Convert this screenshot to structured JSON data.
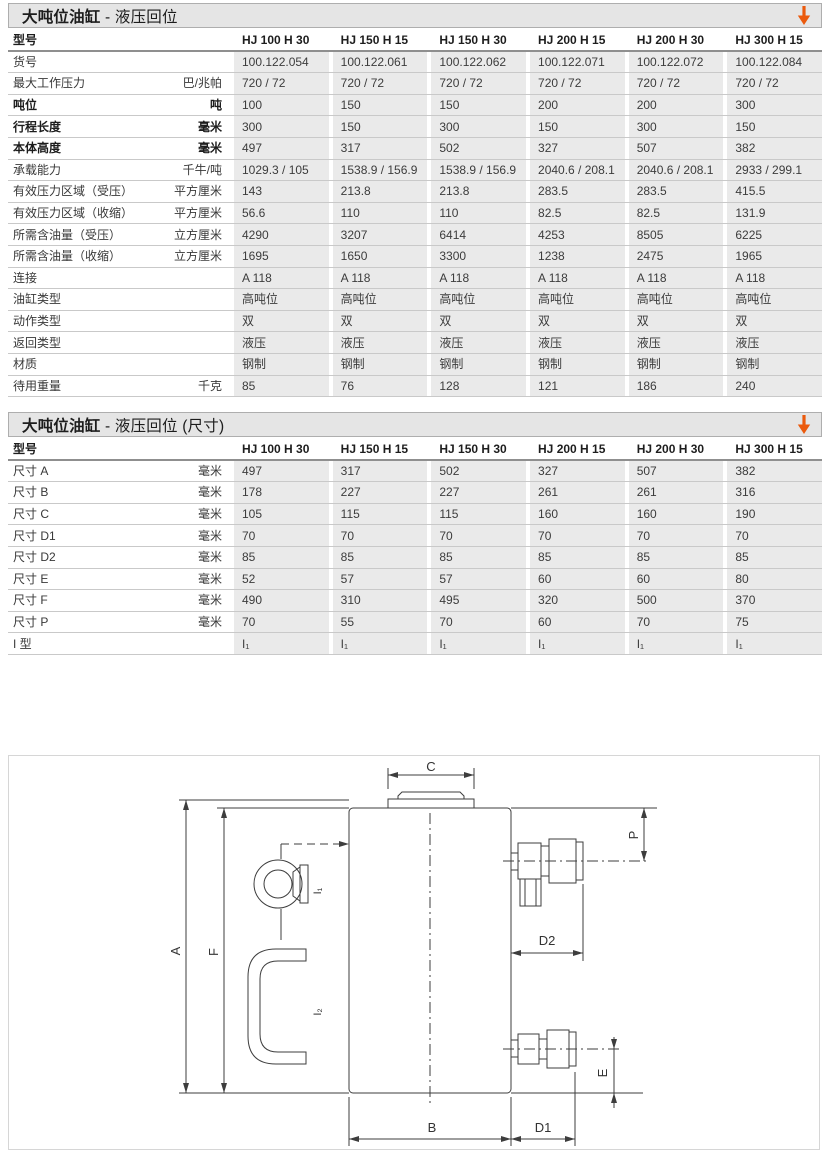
{
  "accent": {
    "arrow_color": "#EB5A0D"
  },
  "table1": {
    "title_bold": "大吨位油缸",
    "title_rest": " - 液压回位",
    "header_label": "型号",
    "models": [
      "HJ 100 H 30",
      "HJ 150 H 15",
      "HJ 150 H 30",
      "HJ 200 H 15",
      "HJ 200 H 30",
      "HJ 300 H 15"
    ],
    "rows": [
      {
        "label": "货号",
        "unit": "",
        "bold": false,
        "values": [
          "100.122.054",
          "100.122.061",
          "100.122.062",
          "100.122.071",
          "100.122.072",
          "100.122.084"
        ]
      },
      {
        "label": "最大工作压力",
        "unit": "巴/兆帕",
        "bold": false,
        "values": [
          "720 / 72",
          "720 / 72",
          "720 / 72",
          "720 / 72",
          "720 / 72",
          "720 / 72"
        ]
      },
      {
        "label": "吨位",
        "unit": "吨",
        "bold": true,
        "values": [
          "100",
          "150",
          "150",
          "200",
          "200",
          "300"
        ]
      },
      {
        "label": "行程长度",
        "unit": "毫米",
        "bold": true,
        "values": [
          "300",
          "150",
          "300",
          "150",
          "300",
          "150"
        ]
      },
      {
        "label": "本体高度",
        "unit": "毫米",
        "bold": true,
        "values": [
          "497",
          "317",
          "502",
          "327",
          "507",
          "382"
        ]
      },
      {
        "label": "承载能力",
        "unit": "千牛/吨",
        "bold": false,
        "values": [
          "1029.3 / 105",
          "1538.9 / 156.9",
          "1538.9 / 156.9",
          "2040.6 / 208.1",
          "2040.6 / 208.1",
          "2933 / 299.1"
        ]
      },
      {
        "label": "有效压力区域（受压）",
        "unit": "平方厘米",
        "bold": false,
        "values": [
          "143",
          "213.8",
          "213.8",
          "283.5",
          "283.5",
          "415.5"
        ]
      },
      {
        "label": "有效压力区域（收缩）",
        "unit": "平方厘米",
        "bold": false,
        "values": [
          "56.6",
          "110",
          "110",
          "82.5",
          "82.5",
          "131.9"
        ]
      },
      {
        "label": "所需含油量（受压）",
        "unit": "立方厘米",
        "bold": false,
        "values": [
          "4290",
          "3207",
          "6414",
          "4253",
          "8505",
          "6225"
        ]
      },
      {
        "label": "所需含油量（收缩）",
        "unit": "立方厘米",
        "bold": false,
        "values": [
          "1695",
          "1650",
          "3300",
          "1238",
          "2475",
          "1965"
        ]
      },
      {
        "label": "连接",
        "unit": "",
        "bold": false,
        "values": [
          "A 118",
          "A 118",
          "A 118",
          "A 118",
          "A 118",
          "A 118"
        ]
      },
      {
        "label": "油缸类型",
        "unit": "",
        "bold": false,
        "values": [
          "高吨位",
          "高吨位",
          "高吨位",
          "高吨位",
          "高吨位",
          "高吨位"
        ]
      },
      {
        "label": "动作类型",
        "unit": "",
        "bold": false,
        "values": [
          "双",
          "双",
          "双",
          "双",
          "双",
          "双"
        ]
      },
      {
        "label": "返回类型",
        "unit": "",
        "bold": false,
        "values": [
          "液压",
          "液压",
          "液压",
          "液压",
          "液压",
          "液压"
        ]
      },
      {
        "label": "材质",
        "unit": "",
        "bold": false,
        "values": [
          "钢制",
          "钢制",
          "钢制",
          "钢制",
          "钢制",
          "钢制"
        ]
      },
      {
        "label": "待用重量",
        "unit": "千克",
        "bold": false,
        "values": [
          "85",
          "76",
          "128",
          "121",
          "186",
          "240"
        ]
      }
    ]
  },
  "table2": {
    "title_bold": "大吨位油缸",
    "title_rest": " - 液压回位 (尺寸)",
    "header_label": "型号",
    "models": [
      "HJ 100 H 30",
      "HJ 150 H 15",
      "HJ 150 H 30",
      "HJ 200 H 15",
      "HJ 200 H 30",
      "HJ 300 H 15"
    ],
    "rows": [
      {
        "label": "尺寸 A",
        "unit": "毫米",
        "bold": false,
        "values": [
          "497",
          "317",
          "502",
          "327",
          "507",
          "382"
        ]
      },
      {
        "label": "尺寸 B",
        "unit": "毫米",
        "bold": false,
        "values": [
          "178",
          "227",
          "227",
          "261",
          "261",
          "316"
        ]
      },
      {
        "label": "尺寸 C",
        "unit": "毫米",
        "bold": false,
        "values": [
          "105",
          "115",
          "115",
          "160",
          "160",
          "190"
        ]
      },
      {
        "label": "尺寸 D1",
        "unit": "毫米",
        "bold": false,
        "values": [
          "70",
          "70",
          "70",
          "70",
          "70",
          "70"
        ]
      },
      {
        "label": "尺寸 D2",
        "unit": "毫米",
        "bold": false,
        "values": [
          "85",
          "85",
          "85",
          "85",
          "85",
          "85"
        ]
      },
      {
        "label": "尺寸 E",
        "unit": "毫米",
        "bold": false,
        "values": [
          "52",
          "57",
          "57",
          "60",
          "60",
          "80"
        ]
      },
      {
        "label": "尺寸 F",
        "unit": "毫米",
        "bold": false,
        "values": [
          "490",
          "310",
          "495",
          "320",
          "500",
          "370"
        ]
      },
      {
        "label": "尺寸 P",
        "unit": "毫米",
        "bold": false,
        "values": [
          "70",
          "55",
          "70",
          "60",
          "70",
          "75"
        ]
      },
      {
        "label": "I 型",
        "unit": "",
        "bold": false,
        "values": [
          "I₁",
          "I₁",
          "I₁",
          "I₁",
          "I₁",
          "I₁"
        ]
      }
    ]
  },
  "diagram": {
    "labels": {
      "A": "A",
      "F": "F",
      "C": "C",
      "P": "P",
      "D2": "D2",
      "E": "E",
      "B": "B",
      "D1": "D1",
      "I1": "I₁",
      "I2": "I₂"
    }
  }
}
